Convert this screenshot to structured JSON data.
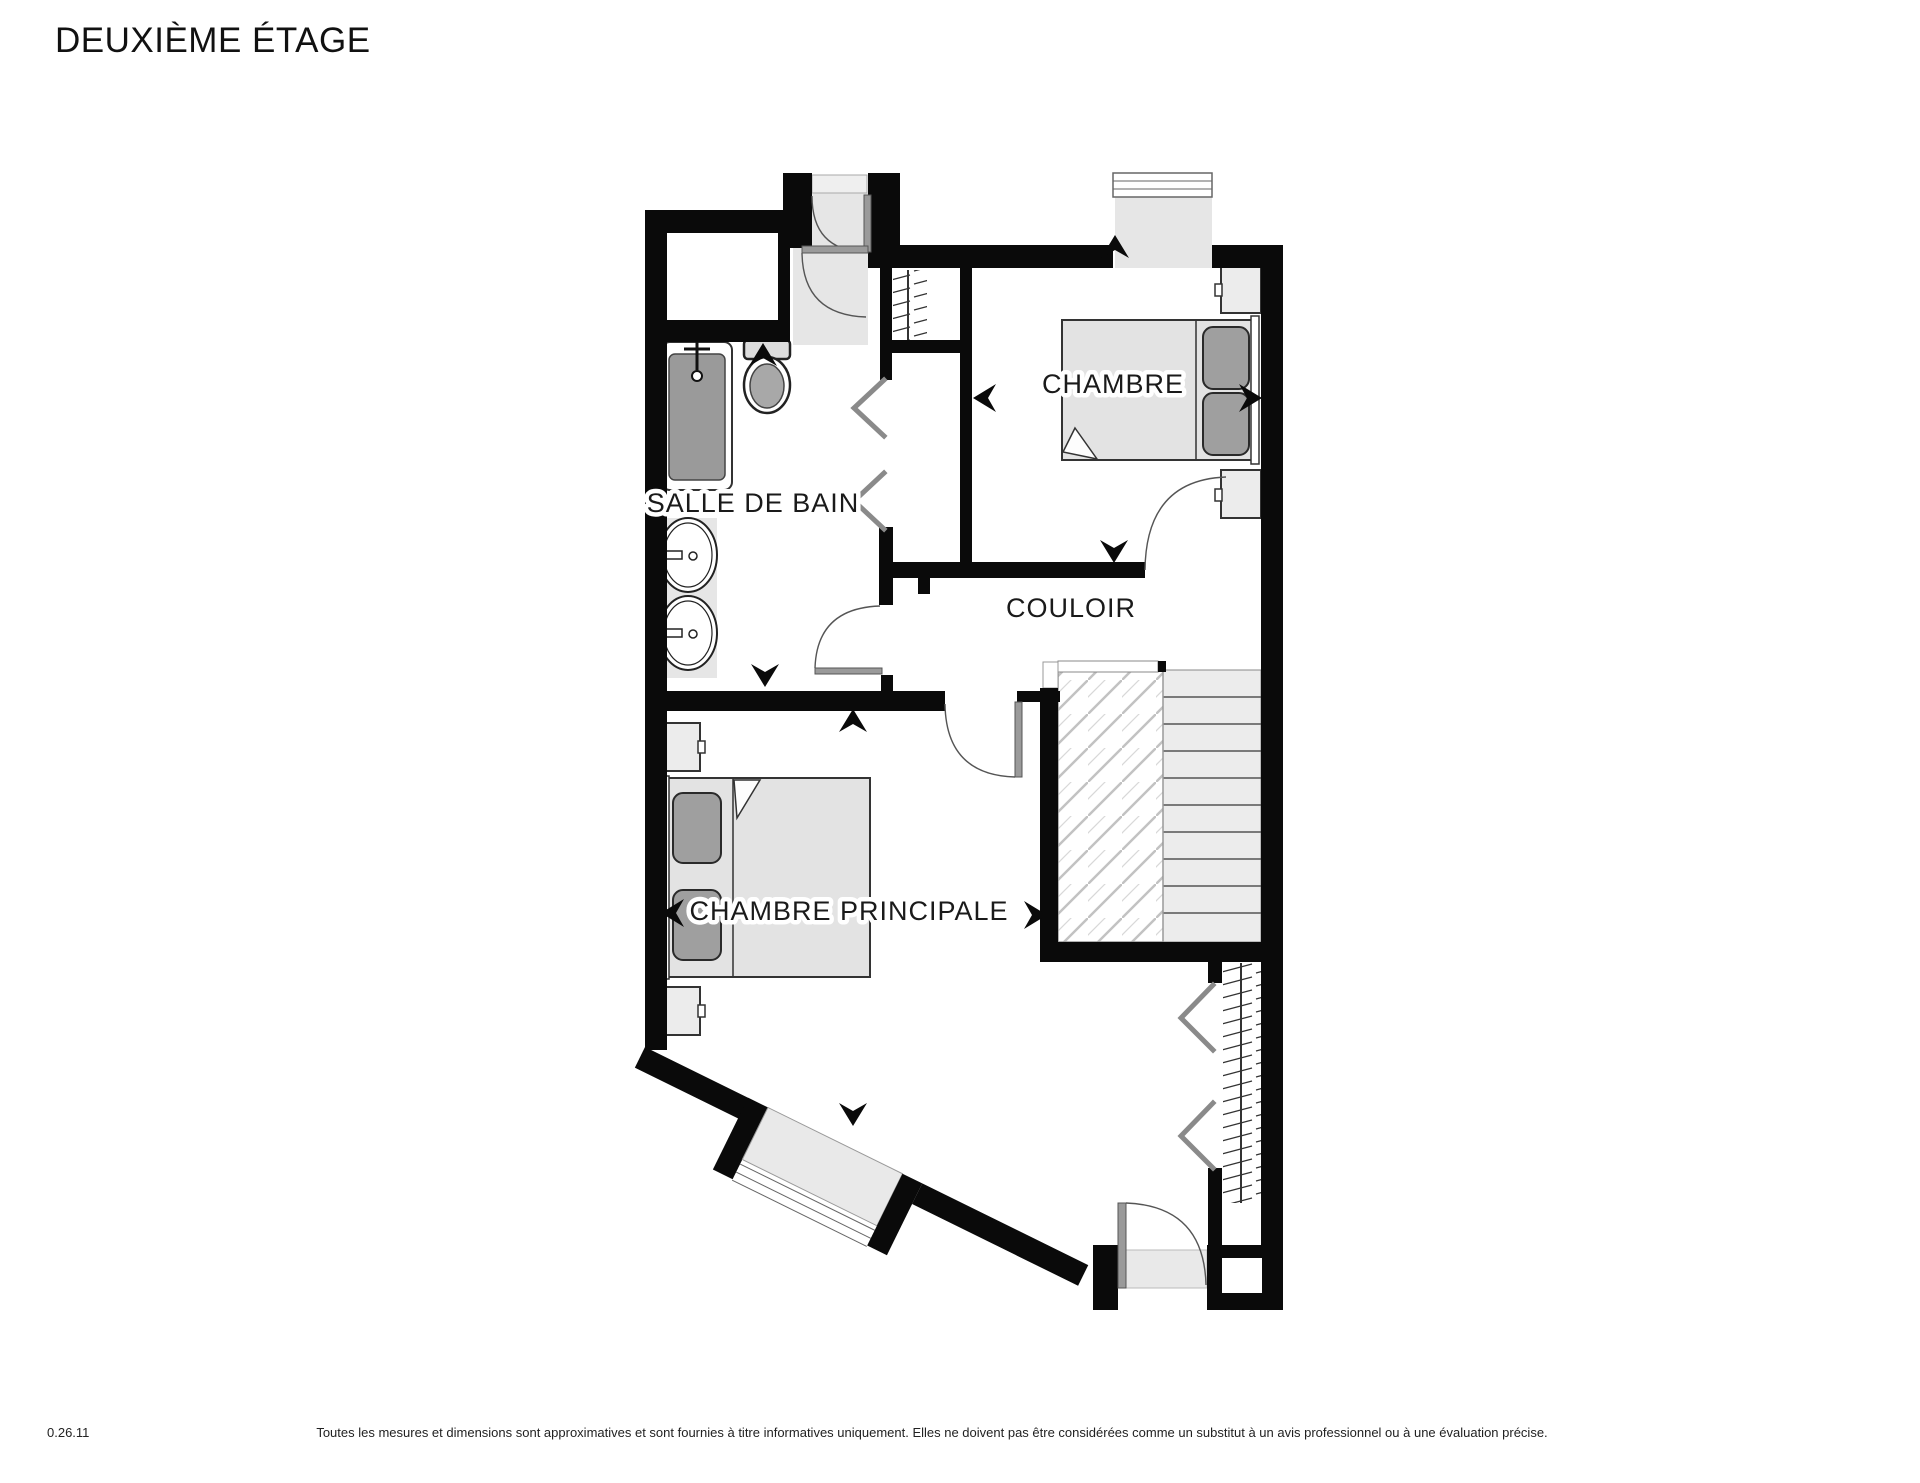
{
  "title": "DEUXIÈME ÉTAGE",
  "rooms": {
    "bathroom": "SALLE DE BAIN",
    "bedroom": "CHAMBRE",
    "hallway": "COULOIR",
    "master_bedroom": "CHAMBRE PRINCIPALE"
  },
  "footer": {
    "version": "0.26.11",
    "disclaimer": "Toutes les mesures et dimensions sont approximatives et sont fournies à titre informatives uniquement. Elles ne doivent pas être considérées comme un substitut à un avis professionnel ou à une évaluation précise."
  },
  "colors": {
    "wall": "#0a0a0a",
    "room_fill": "#ffffff",
    "furniture_fill": "#e7e7e7",
    "pillow_fill": "#9f9f9f",
    "door_leaf": "#9a9a9a",
    "floor_shade": "#e6e6e6"
  }
}
